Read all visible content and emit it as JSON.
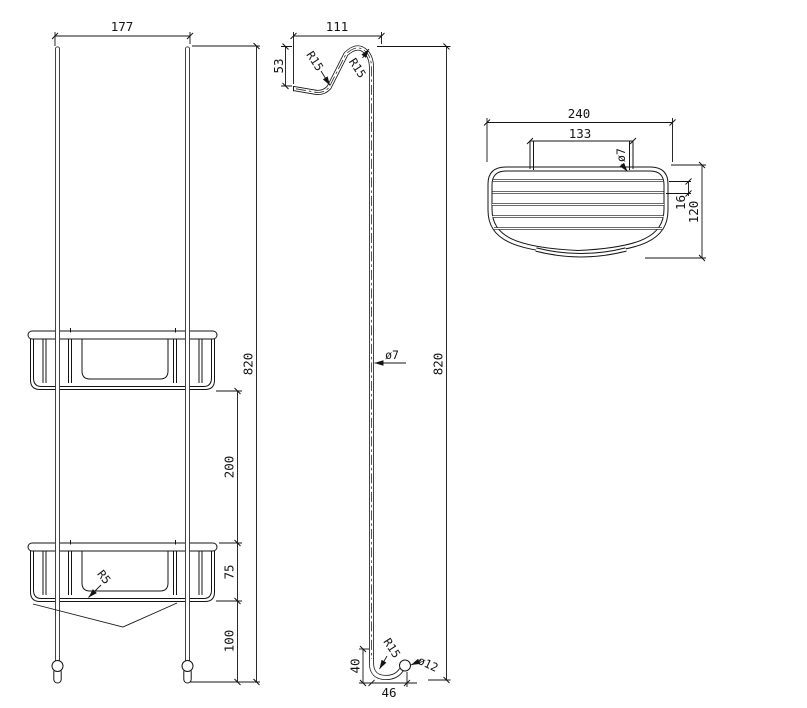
{
  "drawing_type": "technical-orthographic-drawing",
  "views": {
    "front": {
      "label": "front-view",
      "dims": {
        "overall_width": "177",
        "overall_height": "820",
        "basket_spacing": "200",
        "basket_height": "75",
        "bottom_offset": "100",
        "corner_radius": "R5"
      }
    },
    "side": {
      "label": "side-view",
      "dims": {
        "hook_depth": "111",
        "hook_drop": "53",
        "hook_radius_a": "R15",
        "hook_radius_b": "R15",
        "wire_diameter": "ø7",
        "overall_height": "820",
        "foot_height": "40",
        "foot_depth": "46",
        "foot_radius": "R15",
        "ball_diameter": "ø12"
      }
    },
    "top": {
      "label": "top-view",
      "dims": {
        "basket_width": "240",
        "hook_span": "133",
        "wire_diameter": "ø7",
        "wire_pitch": "16",
        "basket_depth": "120"
      }
    }
  },
  "colors": {
    "line": "#141414",
    "background": "#ffffff"
  }
}
